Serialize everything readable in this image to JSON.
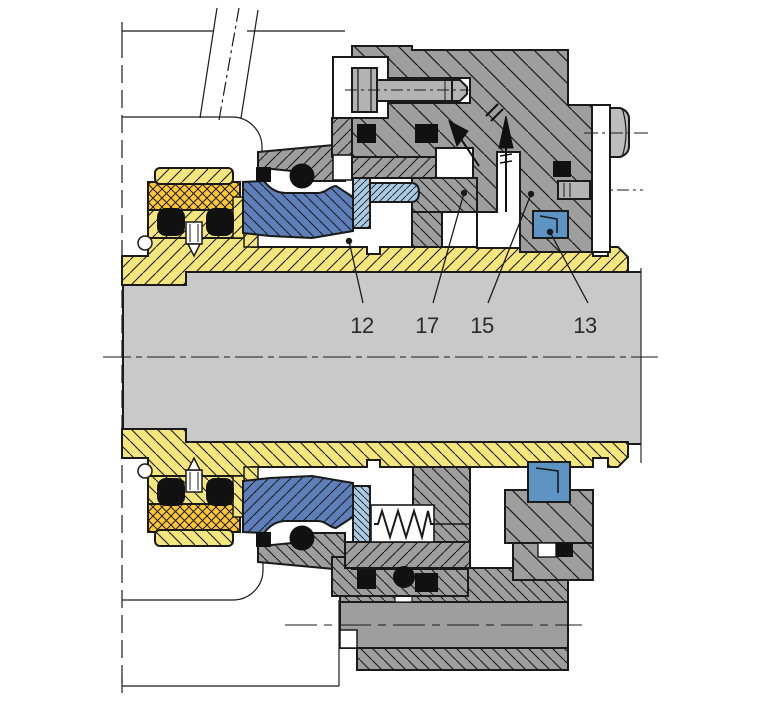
{
  "diagram": {
    "title": "mechanical-seal-cross-section",
    "canvas": {
      "width": 768,
      "height": 716
    },
    "part_labels": [
      {
        "text": "12",
        "lx": 362,
        "ly": 333,
        "ex": 363,
        "ey": 303,
        "dx": 349,
        "dy": 241
      },
      {
        "text": "17",
        "lx": 427,
        "ly": 333,
        "ex": 433,
        "ey": 303,
        "dx": 464,
        "dy": 193
      },
      {
        "text": "15",
        "lx": 482,
        "ly": 333,
        "ex": 488,
        "ey": 303,
        "dx": 531,
        "dy": 194
      },
      {
        "text": "13",
        "lx": 585,
        "ly": 333,
        "ex": 588,
        "ey": 303,
        "dx": 550,
        "dy": 232
      }
    ],
    "colors": {
      "line": "#1a1a1a",
      "shaft_gray": "#c9c9c9",
      "sleeve_yellow": "#f4e67d",
      "packing_orange": "#ffc732",
      "seal_blue_dark": "#5f7fba",
      "seal_blue_light": "#aac9e2",
      "elastomer_blue": "#5d94c4",
      "housing_gray": "#9e9e9e",
      "bolt_gray": "#b3b3b3",
      "label_text": "#2b2b2b"
    }
  }
}
